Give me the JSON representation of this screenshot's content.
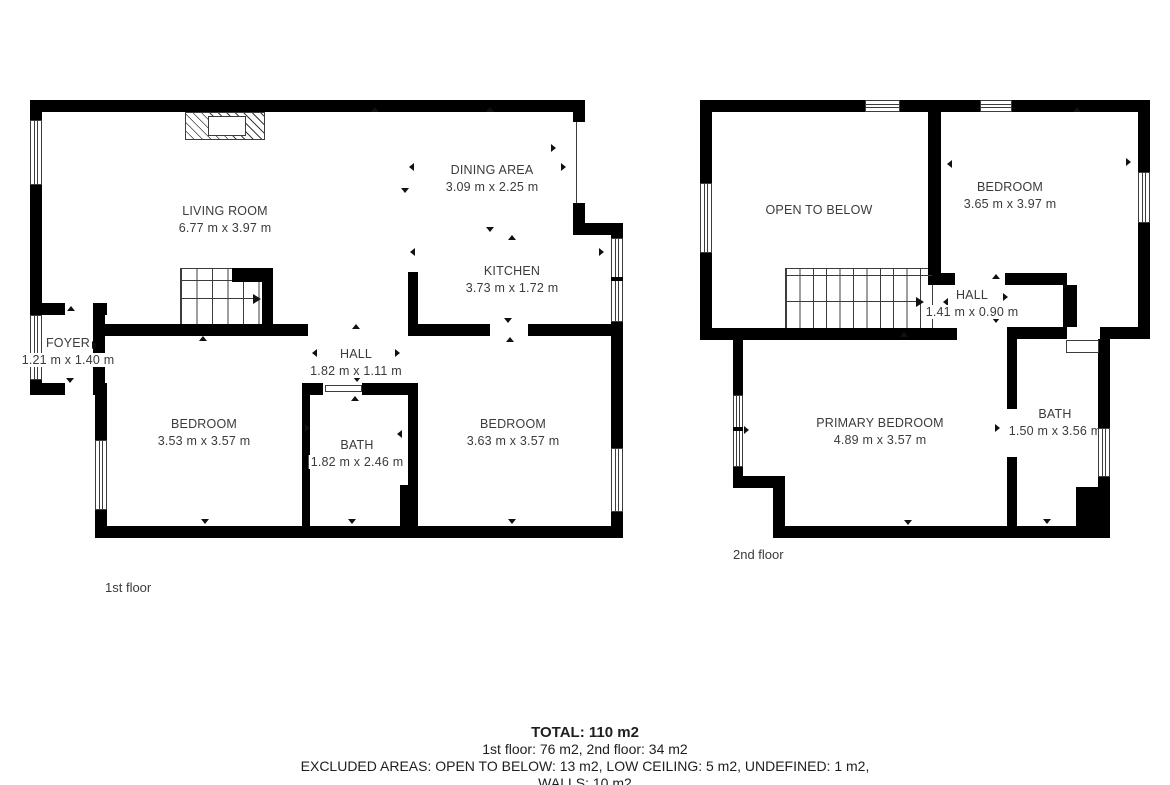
{
  "floors": {
    "first": {
      "label": "1st floor",
      "rooms": {
        "living": {
          "name": "LIVING ROOM",
          "dims": "6.77 m x 3.97 m"
        },
        "dining": {
          "name": "DINING AREA",
          "dims": "3.09 m x 2.25 m"
        },
        "kitchen": {
          "name": "KITCHEN",
          "dims": "3.73 m x 1.72 m"
        },
        "foyer": {
          "name": "FOYER",
          "dims": "1.21 m x 1.40 m"
        },
        "hall": {
          "name": "HALL",
          "dims": "1.82 m x 1.11 m"
        },
        "bedroom_left": {
          "name": "BEDROOM",
          "dims": "3.53 m x 3.57 m"
        },
        "bath": {
          "name": "BATH",
          "dims": "1.82 m x 2.46 m"
        },
        "bedroom_right": {
          "name": "BEDROOM",
          "dims": "3.63 m x 3.57 m"
        }
      }
    },
    "second": {
      "label": "2nd floor",
      "rooms": {
        "open_to_below": {
          "name": "OPEN TO BELOW"
        },
        "bedroom": {
          "name": "BEDROOM",
          "dims": "3.65 m x 3.97 m"
        },
        "hall": {
          "name": "HALL",
          "dims": "1.41 m x 0.90 m"
        },
        "primary_bedroom": {
          "name": "PRIMARY BEDROOM",
          "dims": "4.89 m x 3.57 m"
        },
        "bath": {
          "name": "BATH",
          "dims": "1.50 m x 3.56 m"
        }
      }
    }
  },
  "summary": {
    "total": "TOTAL: 110 m2",
    "floors_line": "1st floor: 76 m2, 2nd floor: 34 m2",
    "excluded_line": "EXCLUDED AREAS: OPEN TO BELOW: 13 m2, LOW CEILING: 5 m2, UNDEFINED: 1 m2,",
    "walls_line": "WALLS: 10 m2"
  },
  "colors": {
    "wall": "#000000",
    "line": "#3c3c3c",
    "room_text": "#3b3b3b",
    "summary_text": "#1e1e1e"
  }
}
